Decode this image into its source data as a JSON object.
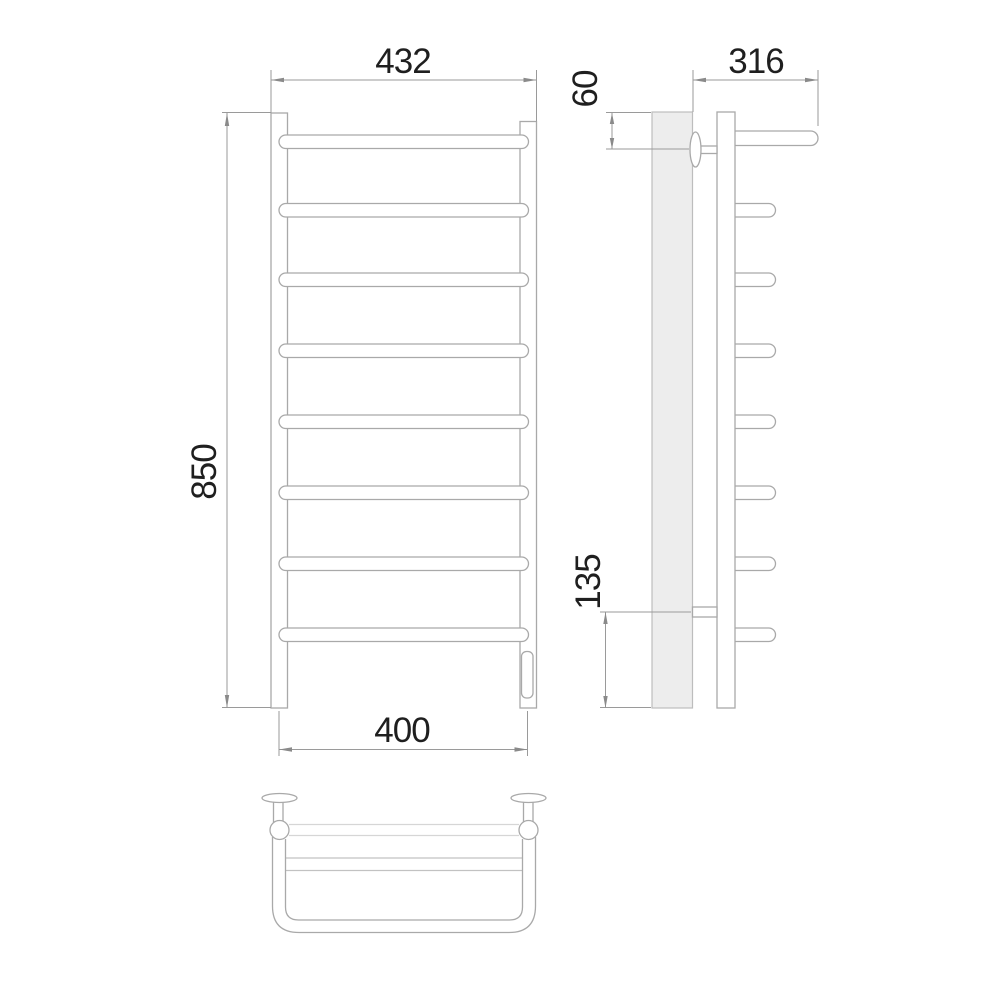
{
  "drawing": {
    "type": "technical-drawing",
    "subject": "ladder-style heated towel rail with top shelf, three orthographic views (front, side, top)",
    "units": "mm",
    "views": {
      "front": {
        "rung_count": 8,
        "dimensions": {
          "overall_width": "432",
          "overall_height": "850",
          "mounting_width": "400"
        }
      },
      "side": {
        "stub_count": 7,
        "dimensions": {
          "shelf_depth": "316",
          "top_bracket_offset": "60",
          "bottom_bracket_offset": "135"
        }
      },
      "top": {
        "wall_flange_count": 2
      }
    },
    "colors": {
      "outline": "#a9a9a9",
      "hidden_line": "#d6d6d6",
      "dimension_line": "#9a9a9a",
      "wall_hatch_fill": "#ededed",
      "text": "#1f1f1f",
      "background": "#ffffff"
    }
  }
}
